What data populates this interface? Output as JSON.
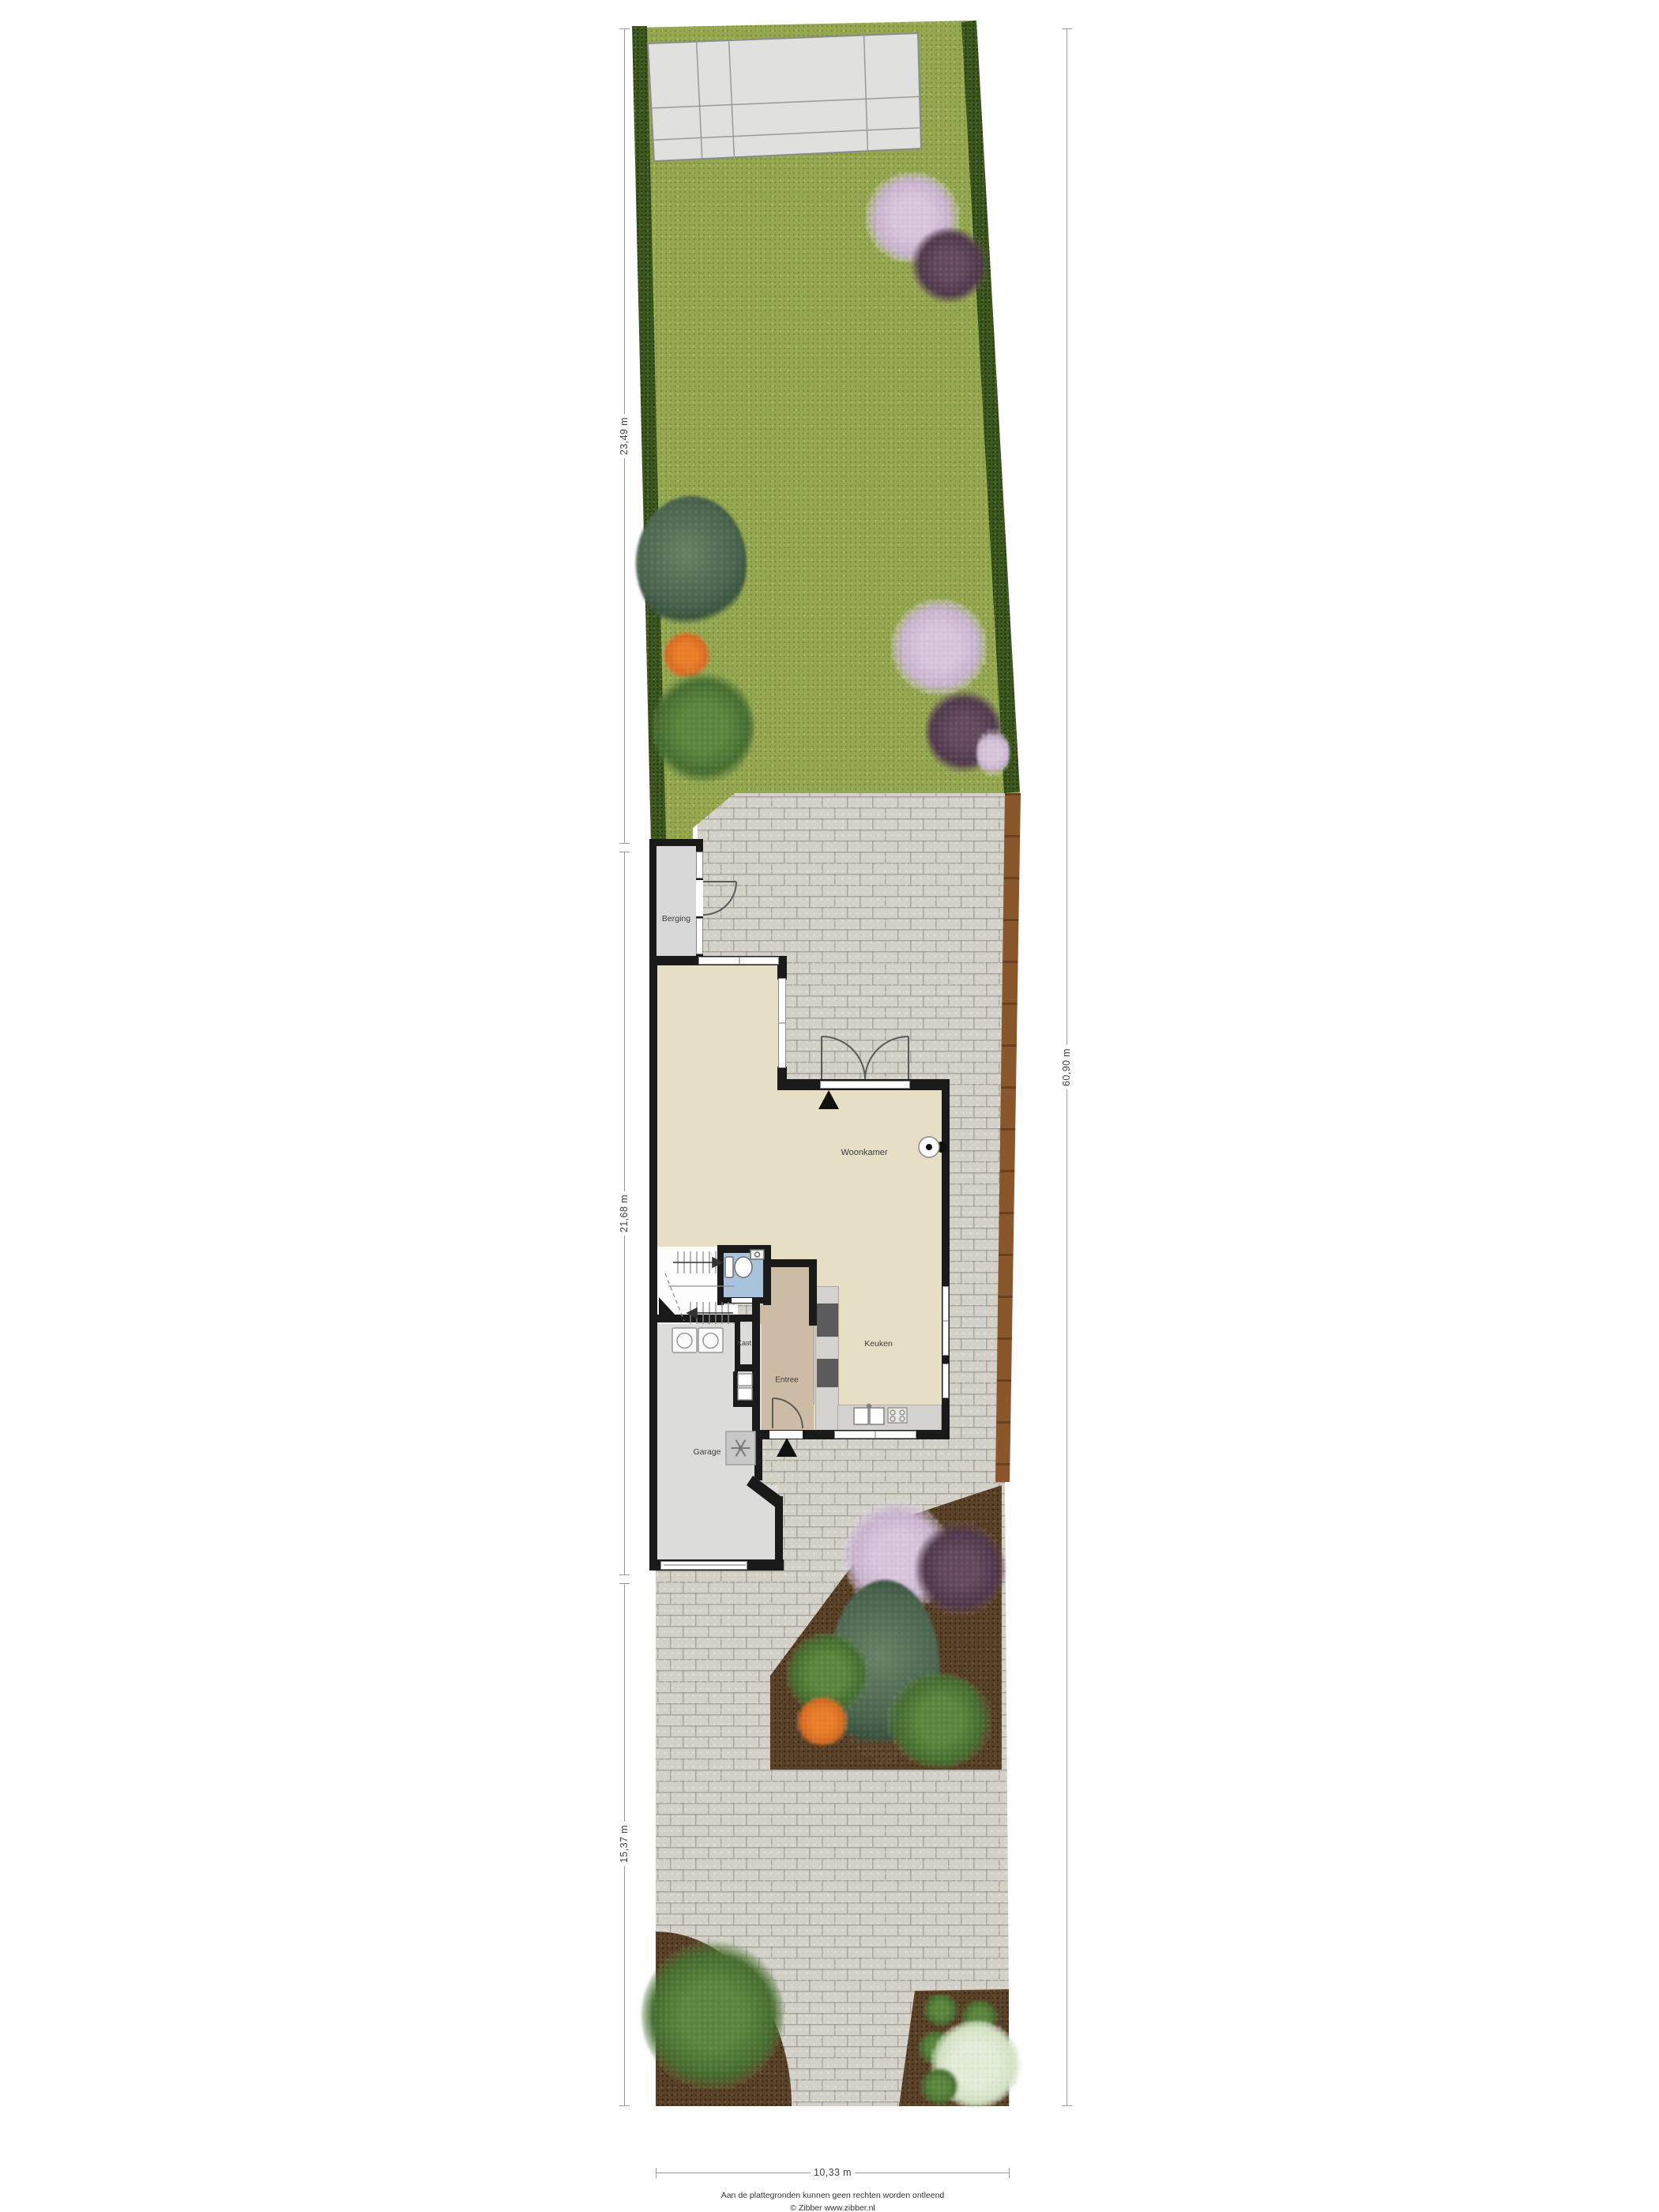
{
  "labels": {
    "berging": "Berging",
    "woonkamer": "Woonkamer",
    "keuken": "Keuken",
    "kast": "Kast",
    "entree": "Entree",
    "garage": "Garage"
  },
  "dimensions": {
    "garden_depth": "23,49 m",
    "house_depth": "21,68 m",
    "front_yard_depth": "15,37 m",
    "total_depth": "60,90 m",
    "plot_width": "10,33 m"
  },
  "footer": {
    "disclaimer": "Aan de plattegronden kunnen geen rechten worden ontleend",
    "credit": "© Zibber www.zibber.nl"
  },
  "icons": {
    "entrance_arrow": "black triangle",
    "door_swing": "quarter arc",
    "stairs_direction": "arrow",
    "toilet": "wc bowl and cistern",
    "washing_machine": "square with round door",
    "heater": "square with fan symbol",
    "wall_lamp": "circle with dot"
  },
  "colors": {
    "wall": "#1a1a1a",
    "grass": "#95a850",
    "hedge": "#3d581f",
    "paving": "#d3d0c8",
    "soil": "#5a4228",
    "fence": "#8a572b",
    "floor_living": "#e7dfc5",
    "floor_entree": "#cdbca5",
    "floor_toilet": "#a9c3dd",
    "floor_garage": "#dcdcda",
    "floor_berging": "#d8d8d8",
    "counter": "#d3d2ce",
    "appliance": "#5b5b5b",
    "dim_line": "#9a9a9a",
    "text": "#3c3c3c"
  }
}
